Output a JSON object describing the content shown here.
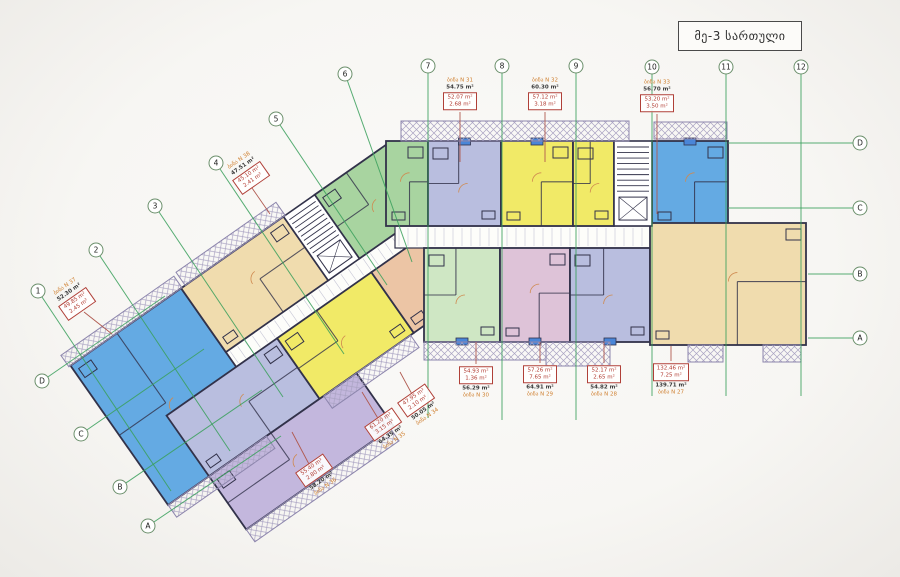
{
  "title": "მე-3 სართული",
  "palette": {
    "blue": "#64aae3",
    "yellow": "#f1ea67",
    "green": "#a8d4a0",
    "lightgreen": "#cfe7c4",
    "lavender": "#b9bedf",
    "pink": "#dec3d8",
    "lilac": "#c3b7dd",
    "beige": "#f0dcae",
    "peach": "#ecc5a5",
    "white": "#ffffff",
    "wall": "#32324a",
    "gridline": "#3aa05c",
    "bubble_stroke": "#6b8f6b",
    "hatch": "#a9a2c2",
    "leader": "#b05a50",
    "door": "#cf8a50",
    "marker": "#4a86d8",
    "corridor": "#fdfdfa"
  },
  "plan": {
    "rotated": {
      "anchor": [
        390,
        142
      ],
      "angle": -35,
      "corridor": {
        "x": -255,
        "y": 78,
        "w": 262,
        "h": 18
      },
      "units": [
        {
          "name": "unit-blue-west",
          "c": "blue",
          "x": -390,
          "y": 0,
          "w": 135,
          "h": 170
        },
        {
          "name": "unit-beige-west",
          "c": "beige",
          "x": -255,
          "y": 0,
          "w": 125,
          "h": 78
        },
        {
          "name": "unit-green-corner",
          "c": "green",
          "x": -92,
          "y": 0,
          "w": 92,
          "h": 78
        },
        {
          "name": "unit-lilac-mid",
          "c": "lavender",
          "x": -340,
          "y": 96,
          "w": 135,
          "h": 74
        },
        {
          "name": "unit-yellow-west",
          "c": "yellow",
          "x": -205,
          "y": 96,
          "w": 115,
          "h": 74
        },
        {
          "name": "unit-peach-west",
          "c": "peach",
          "x": -90,
          "y": 96,
          "w": 98,
          "h": 74
        },
        {
          "name": "unit-lilac-south",
          "c": "lilac",
          "x": -340,
          "y": 170,
          "w": 180,
          "h": 65
        }
      ],
      "stair": {
        "x": -130,
        "y": 0,
        "w": 38,
        "h": 78
      },
      "balconies": [
        {
          "x": -250,
          "y": -16,
          "w": 122,
          "h": 16
        },
        {
          "x": -392,
          "y": -14,
          "w": 138,
          "h": 14
        },
        {
          "x": -200,
          "y": 170,
          "w": 106,
          "h": 15
        },
        {
          "x": -340,
          "y": 235,
          "w": 176,
          "h": 15
        },
        {
          "x": -390,
          "y": 170,
          "w": 120,
          "h": 15
        }
      ]
    },
    "main": {
      "corridor": {
        "x": 395,
        "y": 226,
        "w": 258,
        "h": 22
      },
      "units": [
        {
          "name": "unit-green-top",
          "c": "green",
          "x": 386,
          "y": 141,
          "w": 42,
          "h": 85
        },
        {
          "name": "unit-lavender-top",
          "c": "lavender",
          "x": 428,
          "y": 141,
          "w": 73,
          "h": 85,
          "m": "top"
        },
        {
          "name": "unit-yellow-top-1",
          "c": "yellow",
          "x": 501,
          "y": 141,
          "w": 72,
          "h": 85,
          "m": "top"
        },
        {
          "name": "unit-yellow-top-2",
          "c": "yellow",
          "x": 573,
          "y": 141,
          "w": 41,
          "h": 85
        },
        {
          "name": "unit-blue-top",
          "c": "blue",
          "x": 652,
          "y": 141,
          "w": 76,
          "h": 85,
          "m": "top"
        },
        {
          "name": "unit-lightgreen-bottom",
          "c": "lightgreen",
          "x": 424,
          "y": 248,
          "w": 76,
          "h": 94,
          "m": "bottom"
        },
        {
          "name": "unit-pink-bottom",
          "c": "pink",
          "x": 500,
          "y": 248,
          "w": 70,
          "h": 94,
          "m": "bottom"
        },
        {
          "name": "unit-lavender-bottom",
          "c": "lavender",
          "x": 570,
          "y": 248,
          "w": 80,
          "h": 94,
          "m": "bottom"
        },
        {
          "name": "unit-beige-east",
          "c": "beige",
          "x": 650,
          "y": 223,
          "w": 156,
          "h": 122
        }
      ],
      "stair": {
        "x": 614,
        "y": 141,
        "w": 38,
        "h": 85
      },
      "balconies": [
        {
          "x": 401,
          "y": 121,
          "w": 228,
          "h": 20
        },
        {
          "x": 654,
          "y": 122,
          "w": 73,
          "h": 17
        },
        {
          "x": 424,
          "y": 342,
          "w": 122,
          "h": 18
        },
        {
          "x": 546,
          "y": 342,
          "w": 64,
          "h": 24
        },
        {
          "x": 688,
          "y": 345,
          "w": 35,
          "h": 17
        },
        {
          "x": 763,
          "y": 345,
          "w": 38,
          "h": 17
        }
      ]
    }
  },
  "grid": {
    "number_axes": [
      {
        "label": "1",
        "cx": 38,
        "cy": 291,
        "x2": 171,
        "y2": 491
      },
      {
        "label": "2",
        "cx": 96,
        "cy": 250,
        "x2": 230,
        "y2": 451
      },
      {
        "label": "3",
        "cx": 155,
        "cy": 206,
        "x2": 283,
        "y2": 397
      },
      {
        "label": "4",
        "cx": 216,
        "cy": 163,
        "x2": 344,
        "y2": 354
      },
      {
        "label": "5",
        "cx": 276,
        "cy": 119,
        "x2": 387,
        "y2": 285
      },
      {
        "label": "6",
        "cx": 345,
        "cy": 74,
        "x2": 412,
        "y2": 262
      },
      {
        "label": "7",
        "cx": 428,
        "cy": 66,
        "x2": 428,
        "y2": 418
      },
      {
        "label": "8",
        "cx": 502,
        "cy": 66,
        "x2": 502,
        "y2": 420
      },
      {
        "label": "9",
        "cx": 576,
        "cy": 66,
        "x2": 576,
        "y2": 420
      },
      {
        "label": "10",
        "cx": 652,
        "cy": 67,
        "x2": 652,
        "y2": 396
      },
      {
        "label": "11",
        "cx": 726,
        "cy": 67,
        "x2": 726,
        "y2": 396
      },
      {
        "label": "12",
        "cx": 801,
        "cy": 67,
        "x2": 801,
        "y2": 396
      }
    ],
    "letter_axes_left": [
      {
        "label": "D",
        "cx": 42,
        "cy": 381,
        "x2": 165,
        "y2": 296
      },
      {
        "label": "C",
        "cx": 81,
        "cy": 434,
        "x2": 204,
        "y2": 349
      },
      {
        "label": "B",
        "cx": 120,
        "cy": 487,
        "x2": 262,
        "y2": 390
      },
      {
        "label": "A",
        "cx": 148,
        "cy": 526,
        "x2": 281,
        "y2": 436
      }
    ],
    "letter_axes_right": [
      {
        "label": "D",
        "cx": 860,
        "cy": 143,
        "x1": 728,
        "y1": 143
      },
      {
        "label": "C",
        "cx": 860,
        "cy": 208,
        "x1": 728,
        "y1": 208
      },
      {
        "label": "B",
        "cx": 860,
        "cy": 274,
        "x1": 808,
        "y1": 274
      },
      {
        "label": "A",
        "cx": 860,
        "cy": 338,
        "x1": 808,
        "y1": 338
      }
    ]
  },
  "labels": [
    {
      "x": 460,
      "y": 94,
      "rot": 0,
      "order": "top",
      "apt": "ბინა N 31",
      "area": "54.75 m²",
      "box1": "52.07 m²",
      "box2": "2.68 m²",
      "line": [
        460,
        112,
        460,
        162
      ]
    },
    {
      "x": 545,
      "y": 94,
      "rot": 0,
      "order": "top",
      "apt": "ბინა N 32",
      "area": "60.30 m²",
      "box1": "57.12 m²",
      "box2": "3.18 m²",
      "line": [
        545,
        112,
        545,
        162
      ]
    },
    {
      "x": 657,
      "y": 96,
      "rot": 0,
      "order": "top",
      "apt": "ბინა N 33",
      "area": "56.70 m²",
      "box1": "53.20 m²",
      "box2": "3.50 m²",
      "line": [
        657,
        114,
        657,
        214
      ]
    },
    {
      "x": 247,
      "y": 172,
      "rot": -35,
      "order": "top",
      "apt": "ბინა N 38",
      "area": "47.51 m²",
      "box1": "45.10 m²",
      "box2": "2.41 m²",
      "line": [
        252,
        188,
        270,
        214
      ]
    },
    {
      "x": 73,
      "y": 298,
      "rot": -35,
      "order": "top",
      "apt": "ბინა N 37",
      "area": "52.30 m²",
      "box1": "49.85 m²",
      "box2": "2.45 m²",
      "line": [
        84,
        312,
        112,
        334
      ]
    },
    {
      "x": 476,
      "y": 382,
      "rot": 0,
      "order": "bottom",
      "apt": "ბინა N 30",
      "area": "56.29 m²",
      "box1": "54.93 m²",
      "box2": "1.36 m²",
      "line": [
        476,
        364,
        476,
        342
      ]
    },
    {
      "x": 540,
      "y": 381,
      "rot": 0,
      "order": "bottom",
      "apt": "ბინა N 29",
      "area": "64.91 m²",
      "box1": "57.26 m²",
      "box2": "7.65 m²",
      "line": [
        540,
        363,
        540,
        342
      ]
    },
    {
      "x": 604,
      "y": 381,
      "rot": 0,
      "order": "bottom",
      "apt": "ბინა N 28",
      "area": "54.82 m²",
      "box1": "52.17 m²",
      "box2": "2.65 m²",
      "line": [
        604,
        363,
        604,
        342
      ]
    },
    {
      "x": 671,
      "y": 379,
      "rot": 0,
      "order": "bottom",
      "apt": "ბინა N 27",
      "area": "139.71 m²",
      "box1": "132.46 m²",
      "box2": "7.25 m²",
      "line": [
        671,
        361,
        671,
        346
      ]
    },
    {
      "x": 420,
      "y": 406,
      "rot": -35,
      "order": "bottom",
      "apt": "ბინა N 34",
      "area": "50.05 m²",
      "box1": "47.95 m²",
      "box2": "2.10 m²",
      "line": [
        413,
        396,
        400,
        372
      ]
    },
    {
      "x": 387,
      "y": 430,
      "rot": -35,
      "order": "bottom",
      "apt": "ბინა N 35",
      "area": "64.35 m²",
      "box1": "61.20 m²",
      "box2": "3.15 m²",
      "line": [
        379,
        420,
        362,
        392
      ]
    },
    {
      "x": 318,
      "y": 476,
      "rot": -35,
      "order": "bottom",
      "apt": "ბინა N 36",
      "area": "58.20 m²",
      "box1": "55.40 m²",
      "box2": "2.80 m²",
      "line": [
        310,
        466,
        292,
        432
      ]
    }
  ]
}
